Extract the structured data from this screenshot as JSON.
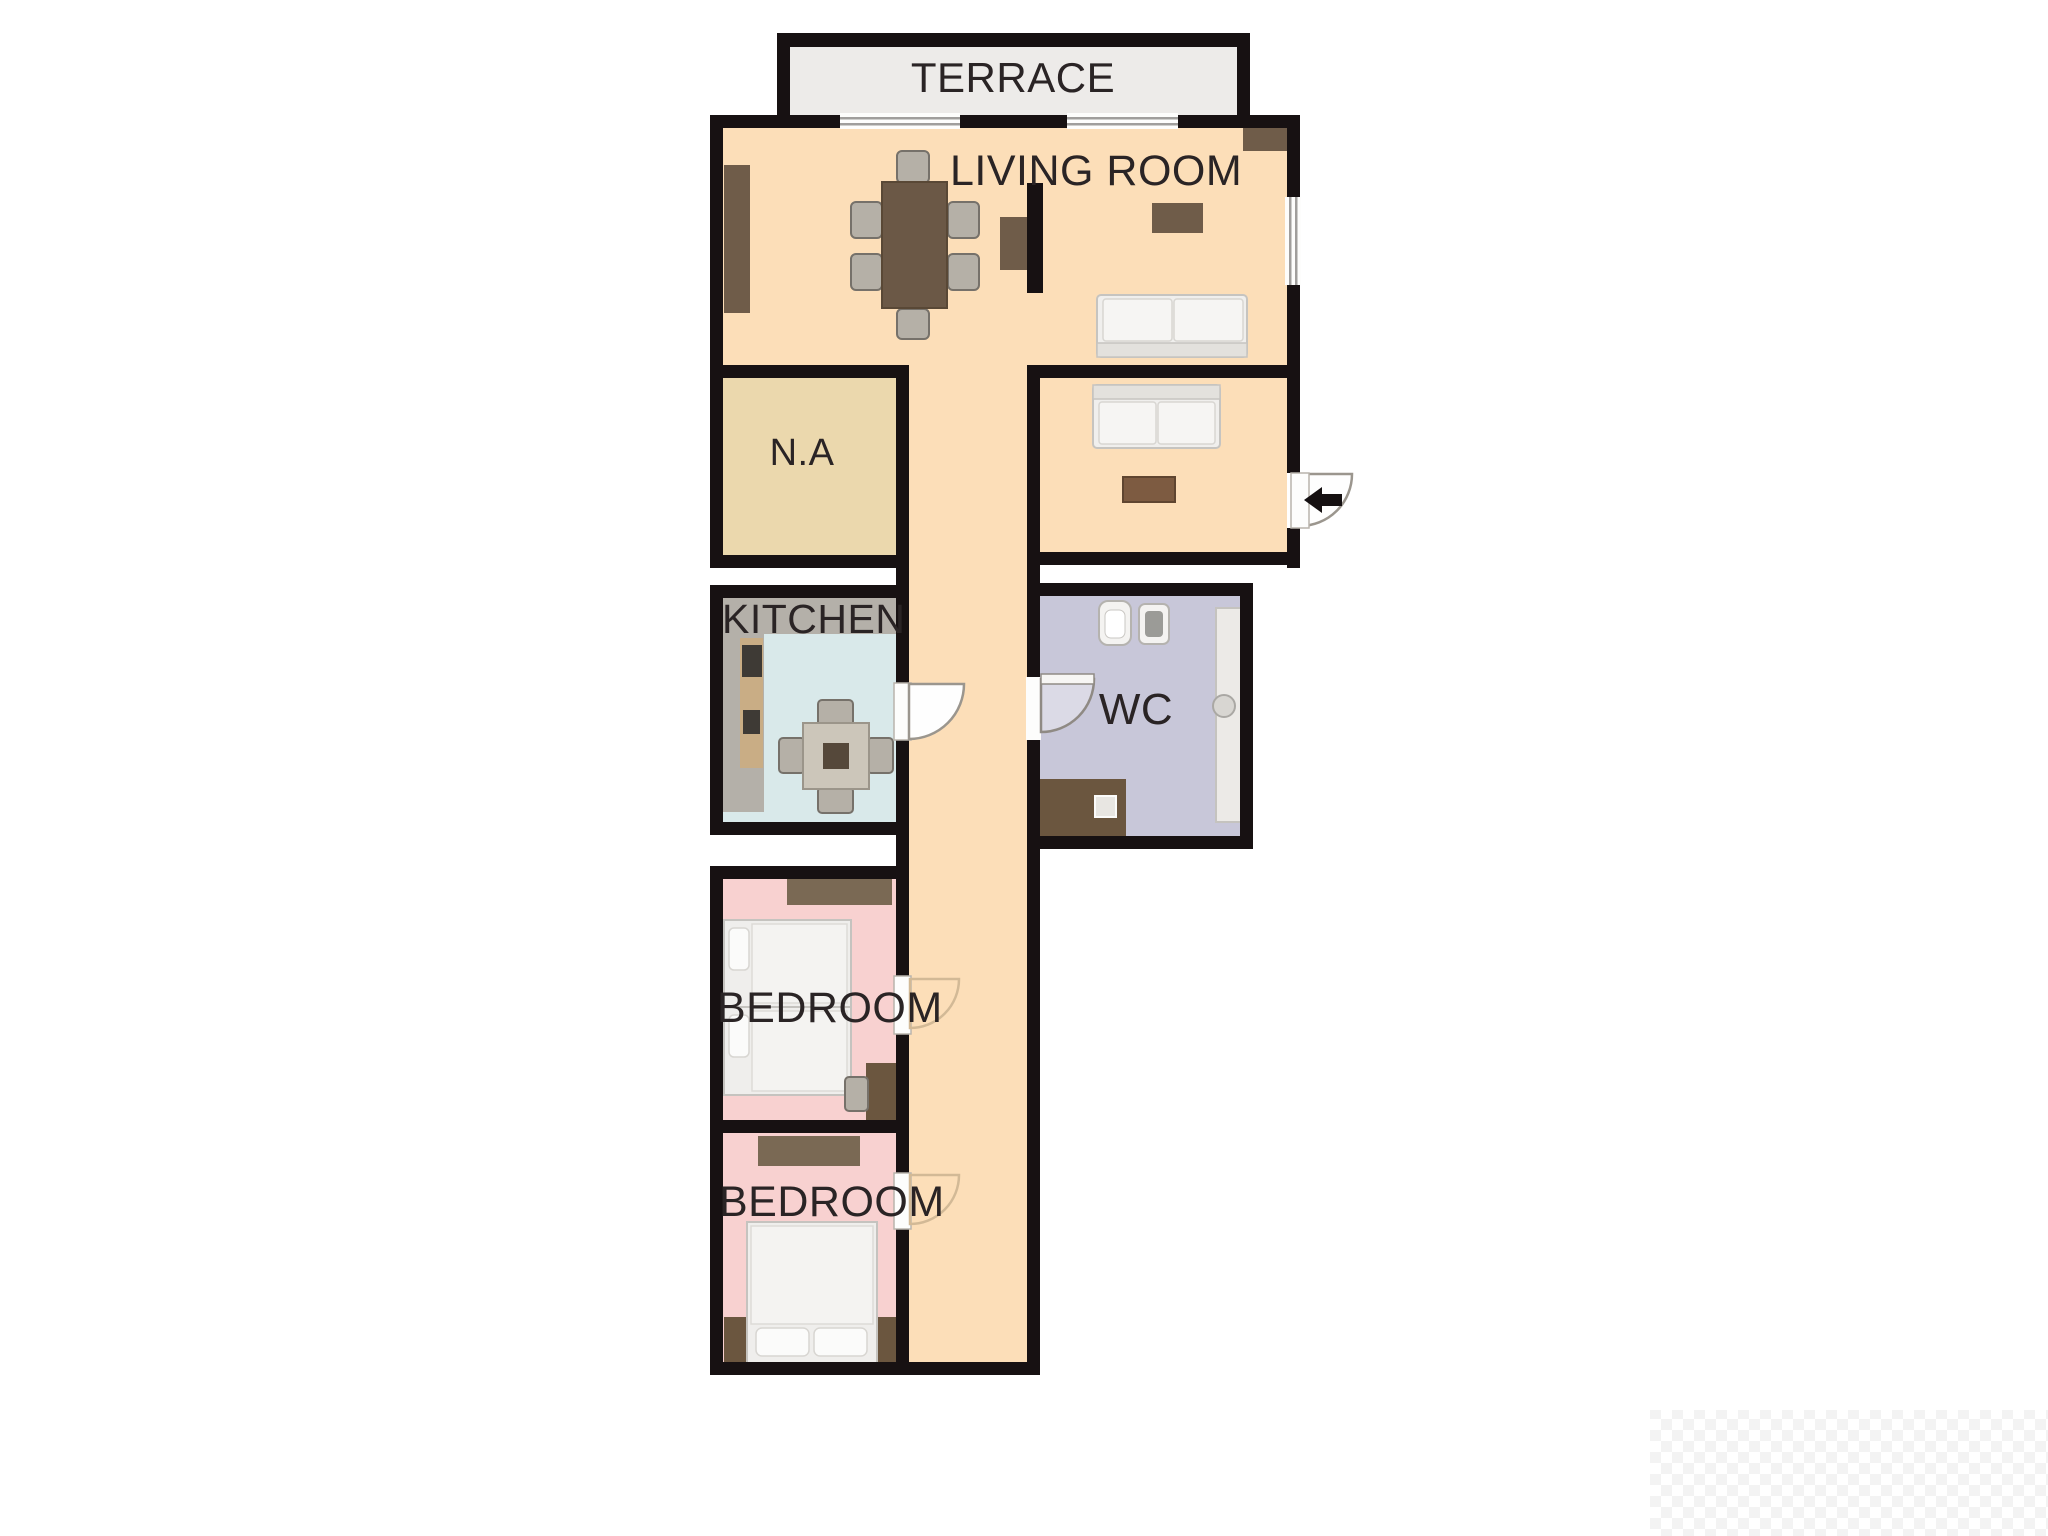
{
  "floor_plan": {
    "type": "apartment-floor-plan",
    "wall_color": "#171112",
    "label_color": "#2a2425",
    "background_color": "#ffffff",
    "rooms": [
      {
        "id": "terrace",
        "label": "TERRACE",
        "floor_color": "#edebe9"
      },
      {
        "id": "living-room",
        "label": "LIVING ROOM",
        "floor_color": "#fcdeb8"
      },
      {
        "id": "na",
        "label": "N.A",
        "floor_color": "#ebd8ad"
      },
      {
        "id": "kitchen",
        "label": "KITCHEN",
        "floor_color": "#d9e9ea"
      },
      {
        "id": "wc",
        "label": "WC",
        "floor_color": "#c8c7d9"
      },
      {
        "id": "bedroom-1",
        "label": "BEDROOM",
        "floor_color": "#f8d1d0"
      },
      {
        "id": "bedroom-2",
        "label": "BEDROOM",
        "floor_color": "#f8d1d0"
      }
    ],
    "entrance": {
      "icon": "entry-arrow-left",
      "arrow_color": "#151011"
    },
    "doors": [
      "entrance-door",
      "kitchen-door",
      "wc-door",
      "bedroom-1-door",
      "bedroom-2-door"
    ],
    "windows": [
      "terrace-window-left",
      "terrace-window-right",
      "living-room-side-window"
    ]
  }
}
